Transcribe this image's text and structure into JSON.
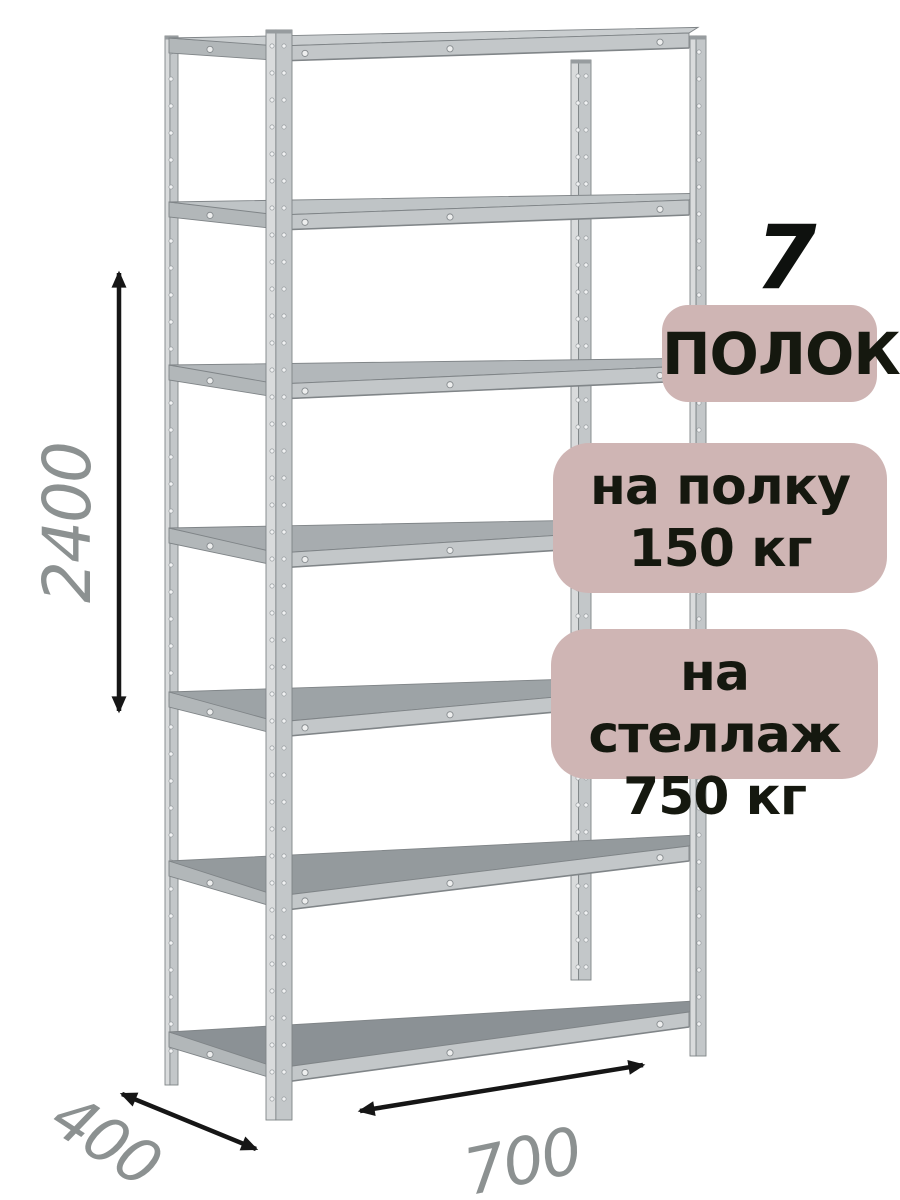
{
  "annotations": {
    "shelf_count": "7",
    "shelf_count_label": "ПОЛОК",
    "per_shelf_load": {
      "line1": "на полку",
      "line2": "150 кг"
    },
    "per_rack_load": {
      "line1": "на стеллаж",
      "line2": "750 кг"
    }
  },
  "dimensions": {
    "height_mm": "2400",
    "depth_mm": "400",
    "width_mm": "700"
  },
  "colors": {
    "badge_background": "#cfb5b4",
    "badge_text": "#15180f",
    "dimension_text": "#8c9191",
    "dimension_arrow": "#161616",
    "metal_light": "#d9dbdc",
    "metal_mid": "#c3c7c9",
    "metal_dark": "#8c9195"
  }
}
